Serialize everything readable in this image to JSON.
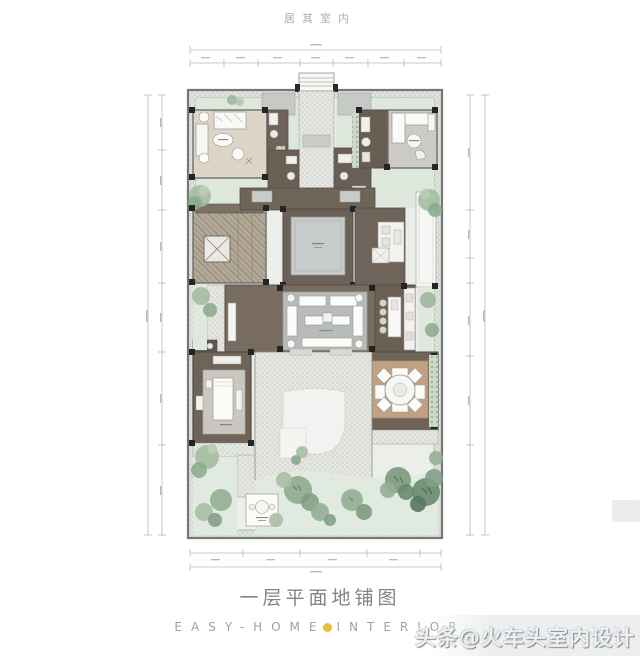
{
  "page": {
    "background": "#ffffff",
    "top_label": "居其室内",
    "caption": "一层平面地铺图",
    "brand": {
      "left": "EASY-HOME",
      "right": "INTERIOR",
      "dot_color": "#e4c03c"
    },
    "watermark": "头条@火车头室内设计"
  },
  "plan": {
    "type": "floor-plan",
    "title": "一层平面地铺图",
    "areas": [
      "entry-steps",
      "entry-path",
      "bedroom-top-left",
      "inner-bathrooms",
      "bathroom-top-right",
      "family-room-top-right",
      "stair-hall",
      "elevator",
      "central-courtyard",
      "pantry",
      "kitchen",
      "living-room",
      "dining-pavilion",
      "bedroom-bottom-left",
      "patio",
      "terrace",
      "garden"
    ],
    "colors": {
      "wall": "#70726f",
      "column": "#242424",
      "dark_floor": "#6e6358",
      "beige_floor": "#ddd6c8",
      "gray_room": "#cbcac6",
      "rug": "#b7bcba",
      "courtyard_green": "#dde7dc",
      "garden_green": "#e3ebe2",
      "paving": "#e8e9e5",
      "dining_mat": "#c0a183",
      "tree_light": "#9db79c",
      "tree_dark": "#6a8b70",
      "dimension": "#b6babd"
    }
  }
}
